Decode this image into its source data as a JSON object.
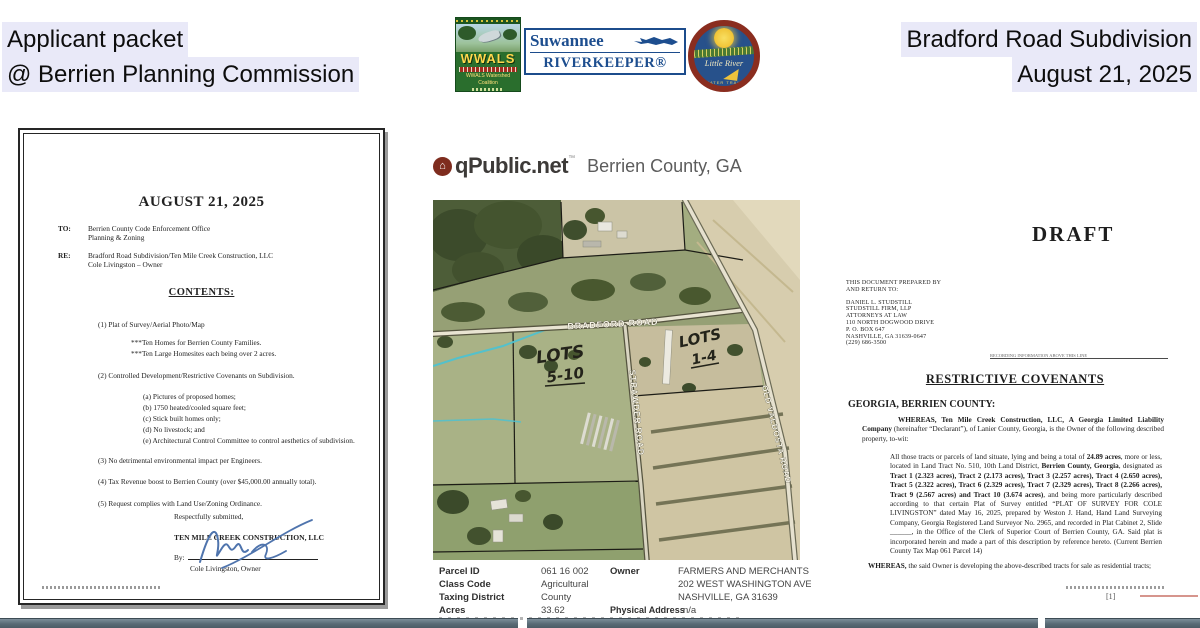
{
  "header": {
    "left": {
      "line1": "Applicant packet",
      "line2": "@ Berrien Planning Commission"
    },
    "right": {
      "line1": "Bradford Road Subdivision",
      "line2": "August 21, 2025"
    },
    "logos": {
      "wwals": {
        "name": "WWALS",
        "subtitle": "WWALS Watershed Coalition"
      },
      "riverkeeper": {
        "line1": "Suwannee",
        "line2": "RIVERKEEPER®"
      },
      "water_trail": {
        "line1": "Little River",
        "line2": "WATER TRAIL"
      }
    }
  },
  "letter": {
    "title": "AUGUST 21, 2025",
    "to_label": "TO:",
    "to1": "Berrien County Code Enforcement Office",
    "to2": "Planning & Zoning",
    "re_label": "RE:",
    "re1": "Bradford Road Subdivision/Ten Mile Creek Construction, LLC",
    "re2": "Cole Livingston – Owner",
    "contents": "CONTENTS:",
    "i1": "(1) Plat of Survey/Aerial Photo/Map",
    "i1a": "***Ten Homes for Berrien County Families.",
    "i1b": "***Ten Large Homesites each being over 2 acres.",
    "i2": "(2) Controlled Development/Restrictive Covenants on Subdivision.",
    "i2a": "(a) Pictures of proposed homes;",
    "i2b": "(b) 1750 heated/cooled square feet;",
    "i2c": "(c) Stick built homes only;",
    "i2d": "(d) No livestock; and",
    "i2e": "(e) Architectural Control Committee to control aesthetics of subdivision.",
    "i3": "(3) No detrimental environmental impact per Engineers.",
    "i4": "(4) Tax Revenue boost to Berrien County (over $45,000.00 annually total).",
    "i5": "(5) Request complies with Land Use/Zoning Ordinance.",
    "closing": "Respectfully submitted,",
    "company": "TEN MILE CREEK CONSTRUCTION, LLC",
    "by_label": "By:",
    "signer": "Cole Livingston, Owner"
  },
  "qpublic": {
    "brand": "qPublic.net",
    "tm": "™",
    "county": "Berrien County, GA",
    "map_labels": {
      "road1": "BRADFORD ROAD",
      "road2": "STRAWDER ROAD",
      "road3": "OLD VALDOSTA ROAD",
      "lots_left_line1": "LOTS",
      "lots_left_line2": "5-10",
      "lots_right_line1": "LOTS",
      "lots_right_line2": "1-4"
    },
    "parcel": {
      "rows": [
        {
          "label": "Parcel ID",
          "value": "061 16 002"
        },
        {
          "label": "Class Code",
          "value": "Agricultural"
        },
        {
          "label": "Taxing District",
          "value": "County"
        },
        {
          "label": "Acres",
          "value": "33.62"
        }
      ],
      "owner_label": "Owner",
      "owner1": "FARMERS AND MERCHANTS BA",
      "owner2": "202 WEST WASHINGTON AVE",
      "owner3": "NASHVILLE, GA 31639",
      "phys_label": "Physical Address",
      "phys_value": "n/a"
    }
  },
  "draft": {
    "watermark": "DRAFT",
    "prep1": "THIS DOCUMENT PREPARED BY",
    "prep2": "AND RETURN TO:",
    "addr1": "DANIEL L. STUDSTILL",
    "addr2": "STUDSTILL FIRM, LLP",
    "addr3": "ATTORNEYS AT LAW",
    "addr4": "110 NORTH DOGWOOD DRIVE",
    "addr5": "P. O. BOX 647",
    "addr6": "NASHVILLE, GA 31639-0647",
    "addr7": "(229) 686-3500",
    "recording_note": "RECORDING INFORMATION ABOVE THIS LINE",
    "heading": "RESTRICTIVE COVENANTS",
    "jurisdiction": "GEORGIA, BERRIEN COUNTY:",
    "p1_bold": "WHEREAS, Ten Mile Creek Construction, LLC, A Georgia Limited Liability Company",
    "p1_rest": " (hereinafter “Declarant”), of Lanier County, Georgia, is the Owner of the following described property, to-wit:",
    "p2_s1": "All those tracts or parcels of land situate, lying and being a total of ",
    "p2_b1": "24.89 acres",
    "p2_s2": ", more or less, located in Land Tract No. 510, 10th Land District, ",
    "p2_b2": "Berrien County, Georgia",
    "p2_s3": ", designated as ",
    "p2_b3": "Tract 1 (2.323 acres), Tract 2 (2.173 acres), Tract 3 (2.257 acres), Tract 4 (2.650 acres), Tract 5 (2.322 acres), Tract 6 (2.329 acres), Tract 7 (2.329 acres), Tract 8 (2.266 acres), Tract 9 (2.567 acres) and Tract 10 (3.674 acres)",
    "p2_s4": ", and being more particularly described according to that certain Plat of Survey entitled “PLAT OF SURVEY FOR COLE LIVINGSTON” dated May 16, 2025, prepared by Weston J. Hand, Hand Land Surveying Company, Georgia Registered Land Surveyor No. 2965, and recorded in Plat Cabinet 2, Slide ______, in the Office of the Clerk of Superior Court of Berrien County, GA. Said plat is incorporated herein and made a part of this description by reference hereto. (Current Berrien County Tax Map 061 Parcel 14)",
    "p3_bold": "WHEREAS,",
    "p3_rest": " the said Owner is developing the above-described tracts for sale as residential tracts;",
    "page_number": "[1]"
  }
}
